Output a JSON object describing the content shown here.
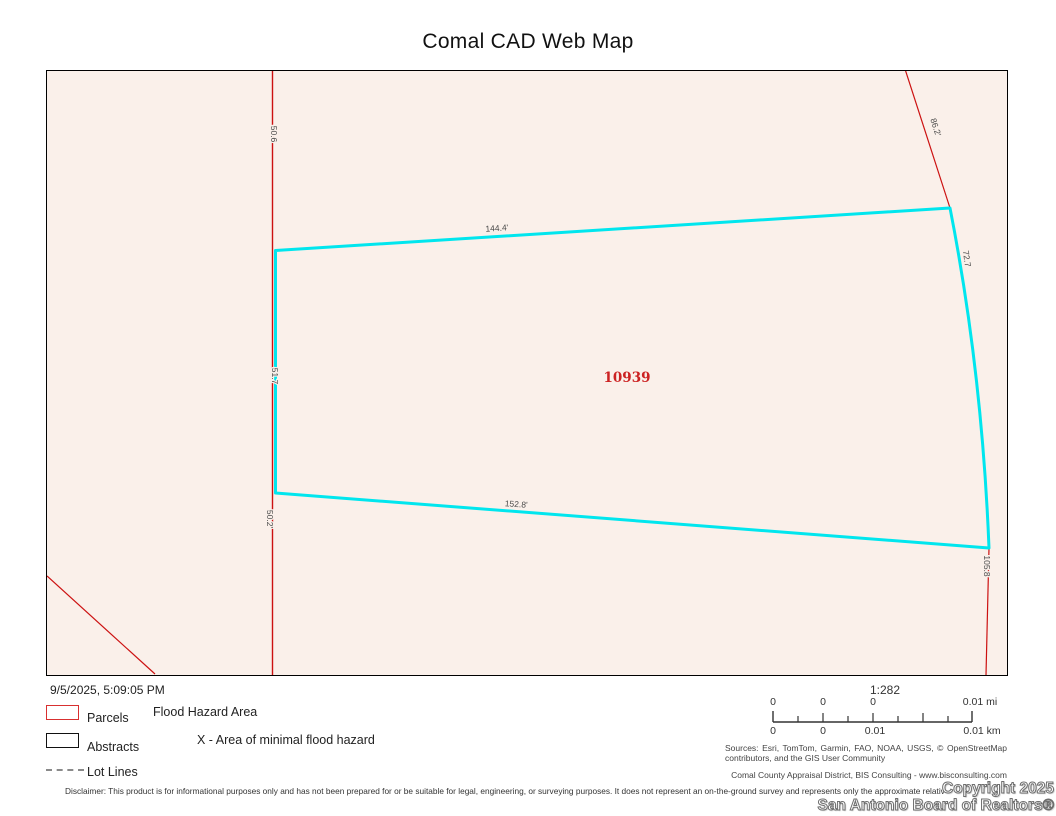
{
  "title": "Comal CAD Web Map",
  "map": {
    "parcel_id": "10939",
    "labels": {
      "top_edge": "144.4'",
      "bottom_edge": "152.8'",
      "left_upper": "50.6",
      "left_middle": "51.7",
      "left_lower": "50.2'",
      "right_upper": "86.2'",
      "right_edge": "72.7",
      "right_lower": "105.8"
    },
    "colors": {
      "highlight": "#00e6ee",
      "parcel_line": "#cc1111",
      "background": "#faf0ea",
      "parcel_id_color": "#cc2222"
    }
  },
  "footer": {
    "timestamp": "9/5/2025, 5:09:05 PM",
    "legend": {
      "items": [
        {
          "label": "Parcels",
          "swatch": "red-outline-box"
        },
        {
          "label": "Abstracts",
          "swatch": "black-outline-box"
        },
        {
          "label": "Lot Lines",
          "swatch": "dashed-line"
        }
      ],
      "flood_heading": "Flood Hazard Area",
      "flood_item": "X - Area of minimal flood hazard"
    },
    "scale": {
      "ratio": "1:282",
      "top_labels": [
        "0",
        "0",
        "0",
        "0.01 mi"
      ],
      "bottom_labels": [
        "0",
        "0",
        "0.01",
        "0.01 km"
      ]
    },
    "sources": "Sources: Esri, TomTom, Garmin, FAO, NOAA, USGS, © OpenStreetMap contributors, and the GIS User Community",
    "attribution": "Comal County Appraisal District, BIS Consulting - www.bisconsulting.com",
    "disclaimer": "Disclaimer: This product is for informational purposes only and has not been prepared for or be suitable for legal, engineering, or surveying purposes. It does not represent an on-the-ground survey and represents only the approximate relative location",
    "watermark_line1": "Copyright 2025",
    "watermark_line2": "San Antonio Board of Realtors®"
  }
}
